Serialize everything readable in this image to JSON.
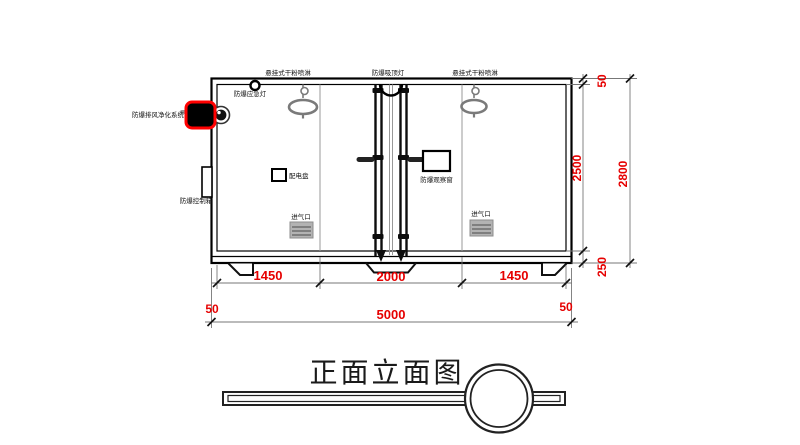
{
  "drawing": {
    "title": "正面立面图",
    "equipment_labels": {
      "sprinkler_left": "悬挂式干粉喷淋",
      "ceiling_light": "防爆吸顶灯",
      "sprinkler_right": "悬挂式干粉喷淋",
      "emergency_light": "防爆应急灯",
      "exhaust_purifier": "防爆排风净化系统",
      "control_box": "防爆控制箱",
      "power_panel": "配电盘",
      "observation_window": "防爆观察窗",
      "air_inlet_left": "进气口",
      "air_inlet_right": "进气口"
    },
    "dimensions": {
      "width_left_bay": "1450",
      "width_center_bay": "2000",
      "width_right_bay": "1450",
      "width_total": "5000",
      "wall_thickness_left": "50",
      "wall_thickness_right": "50",
      "roof_thickness": "50",
      "interior_height": "2500",
      "base_height": "250",
      "height_total": "2800"
    },
    "colors": {
      "dimension_text": "#e60000",
      "highlight": "#ff0000",
      "linework": "#000000",
      "gray_fixture": "#7a7a7a"
    }
  }
}
